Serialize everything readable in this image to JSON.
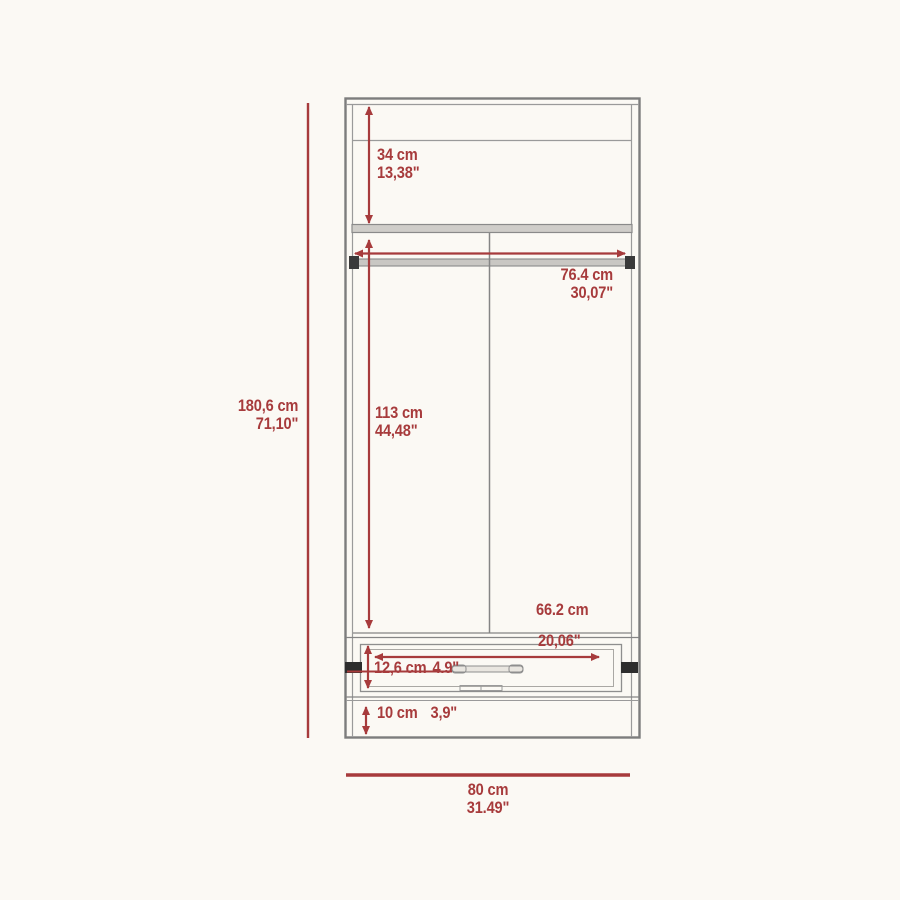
{
  "diagram": {
    "title": "wardrobe-dimension-drawing",
    "accent_color": "#a73b3c",
    "line_color": "#8e8e8e",
    "background": "#fbf9f4",
    "dimensions": {
      "overall_height": {
        "cm": "180,6 cm",
        "in": "71,10\""
      },
      "top_compartment": {
        "cm": "34 cm",
        "in": "13,38\""
      },
      "rod_width": {
        "cm": "76.4 cm",
        "in": "30,07\""
      },
      "door_height": {
        "cm": "113 cm",
        "in": "44,48\""
      },
      "drawer_width": {
        "cm": "66.2 cm",
        "in": "20,06\""
      },
      "drawer_height": {
        "cm": "12,6 cm",
        "in": "4.9\""
      },
      "base_height": {
        "cm": "10 cm",
        "in": "3,9\""
      },
      "overall_width": {
        "cm": "80 cm",
        "in": "31.49\""
      }
    }
  }
}
